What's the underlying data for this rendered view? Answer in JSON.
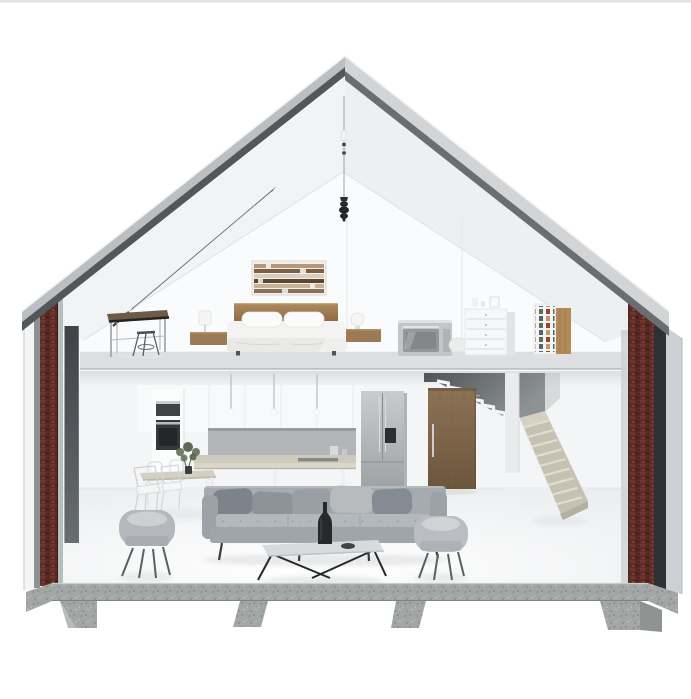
{
  "meta": {
    "subject": "isometric-cutaway-house-render",
    "view": "cross-section dollhouse view, gable roof, two levels"
  },
  "palette": {
    "background": "#ffffff",
    "top_border": "#e2e2e2",
    "roof_outer_left": "#bcbfc1",
    "roof_outer_right": "#d2d4d6",
    "roof_band_left": "#53575b",
    "roof_band_right": "#696e72",
    "ridge_edge": "#f2f3f4",
    "interior_wall": "#fafbfc",
    "under_loft_wall": "#f4f5f7",
    "loft_slab_face": "#dcdee0",
    "brick_red": "#5c2b26",
    "concrete": "#a2a6a5",
    "window_glass_top": "#3f4246",
    "window_glass_bottom": "#686d70",
    "stair_wall_dark": "#4f5357",
    "stair_wall_light": "#8d9295",
    "stair_tread": "#c6c1b2",
    "stair_stringer": "#eceef0",
    "door_wood_top": "#8d7356",
    "door_wood_bottom": "#6b563c",
    "headboard_top": "#ad8a5f",
    "headboard_bottom": "#8a6742",
    "nightstand_wood": "#9b7b53",
    "shelf_wood_panel": "#b18a57",
    "fridge_top": "#c9cccd",
    "fridge_bottom": "#9ea2a5",
    "counter_top": "#cfcabb",
    "sofa_body": "#a6abaf",
    "sofa_seat": "#b3b8bc",
    "armchair_shell": "#b4b8bc",
    "coffee_table_top": "#d8dade",
    "plant_green": "#5f7050",
    "microwave_metal": "#c3c6c8",
    "skylight_frame": "#26292b"
  },
  "scene": {
    "structure": [
      "gable-roof",
      "brick-wall-cores",
      "glass-panel",
      "loft-floor-slab",
      "concrete-foundation",
      "pier-footings"
    ],
    "loft": [
      "skylight",
      "pendant-light",
      "desk",
      "stool",
      "floating-nightstands",
      "table-lamps",
      "bed",
      "wall-art",
      "microwave-oven",
      "drawer-dresser",
      "media-shelf",
      "wood-panel"
    ],
    "ground_floor": [
      "oven-tower",
      "upper-cabinets",
      "backsplash",
      "island-counter",
      "pendant-rods",
      "refrigerator",
      "upper-stair-flight",
      "lower-stair-flight",
      "wooden-door",
      "dining-table",
      "dining-chairs",
      "plant",
      "sofa",
      "throw-pillows",
      "coffee-table",
      "bottle",
      "armchairs"
    ]
  }
}
